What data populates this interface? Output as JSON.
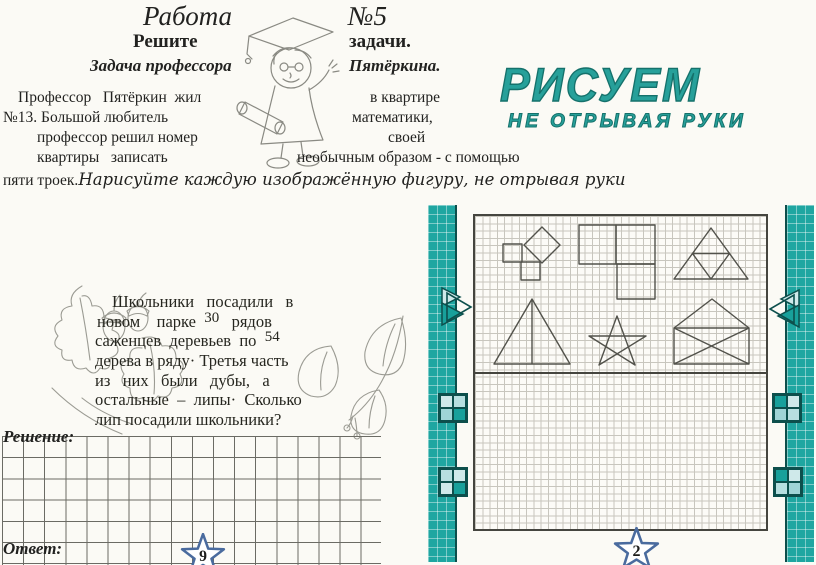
{
  "colors": {
    "teal": "#1fa6a1",
    "teal_dark": "#0d4f4c",
    "teal_light": "#cfe9ea",
    "logo_teal": "#27a09a",
    "star_outline": "#4a6b9e",
    "grid_dark": "#6b6b64",
    "grid_fine": "#c8c6be",
    "ink": "#222220"
  },
  "left_page": {
    "title": {
      "work": "Работа",
      "number": "№5"
    },
    "heading": {
      "left": "Решите",
      "right": "задачи."
    },
    "subheading": {
      "left": "Задача профессора",
      "right": "Пятёркина."
    },
    "professor_paragraph": {
      "l1_left": "Профессор   Пятёркин  жил",
      "l1_right": "в квартире",
      "l2_left": "№13. Большой любитель",
      "l2_right": "математики,",
      "l3_left": "профессор решил номер",
      "l3_right": "своей",
      "l4_left": "квартиры   записать",
      "l4_right": "необычным образом - с помощью",
      "l5_plain": "пяти троек.",
      "l5_italic": "Нарисуйте каждую изображённую фигуру, не отрывая руки"
    },
    "trees_task": {
      "line1": "Школьники   посадили   в",
      "line2_pre": "новом    парке  ",
      "line2_num": "30",
      "line2_post": "   рядов",
      "line3_pre": "саженцев  деревьев  по  ",
      "line3_num": "54",
      "line4": "дерева в ряду· Третья часть",
      "line5": "из   них   были   дубы,   а",
      "line6": "остальные  –  липы·  Сколько",
      "line7": "лип посадили школьники?"
    },
    "solution_label": "Решение:",
    "answer_label": "Ответ:",
    "page_number": "9"
  },
  "right_page": {
    "logo": {
      "line1": "РИСУЕМ",
      "line2": "НЕ ОТРЫВАЯ РУКИ"
    },
    "figures": [
      "pythagoras-squares",
      "l-shaped-squares",
      "triangle-with-midsegments",
      "triangle-with-median",
      "five-pointed-star",
      "envelope"
    ],
    "page_number": "2"
  }
}
